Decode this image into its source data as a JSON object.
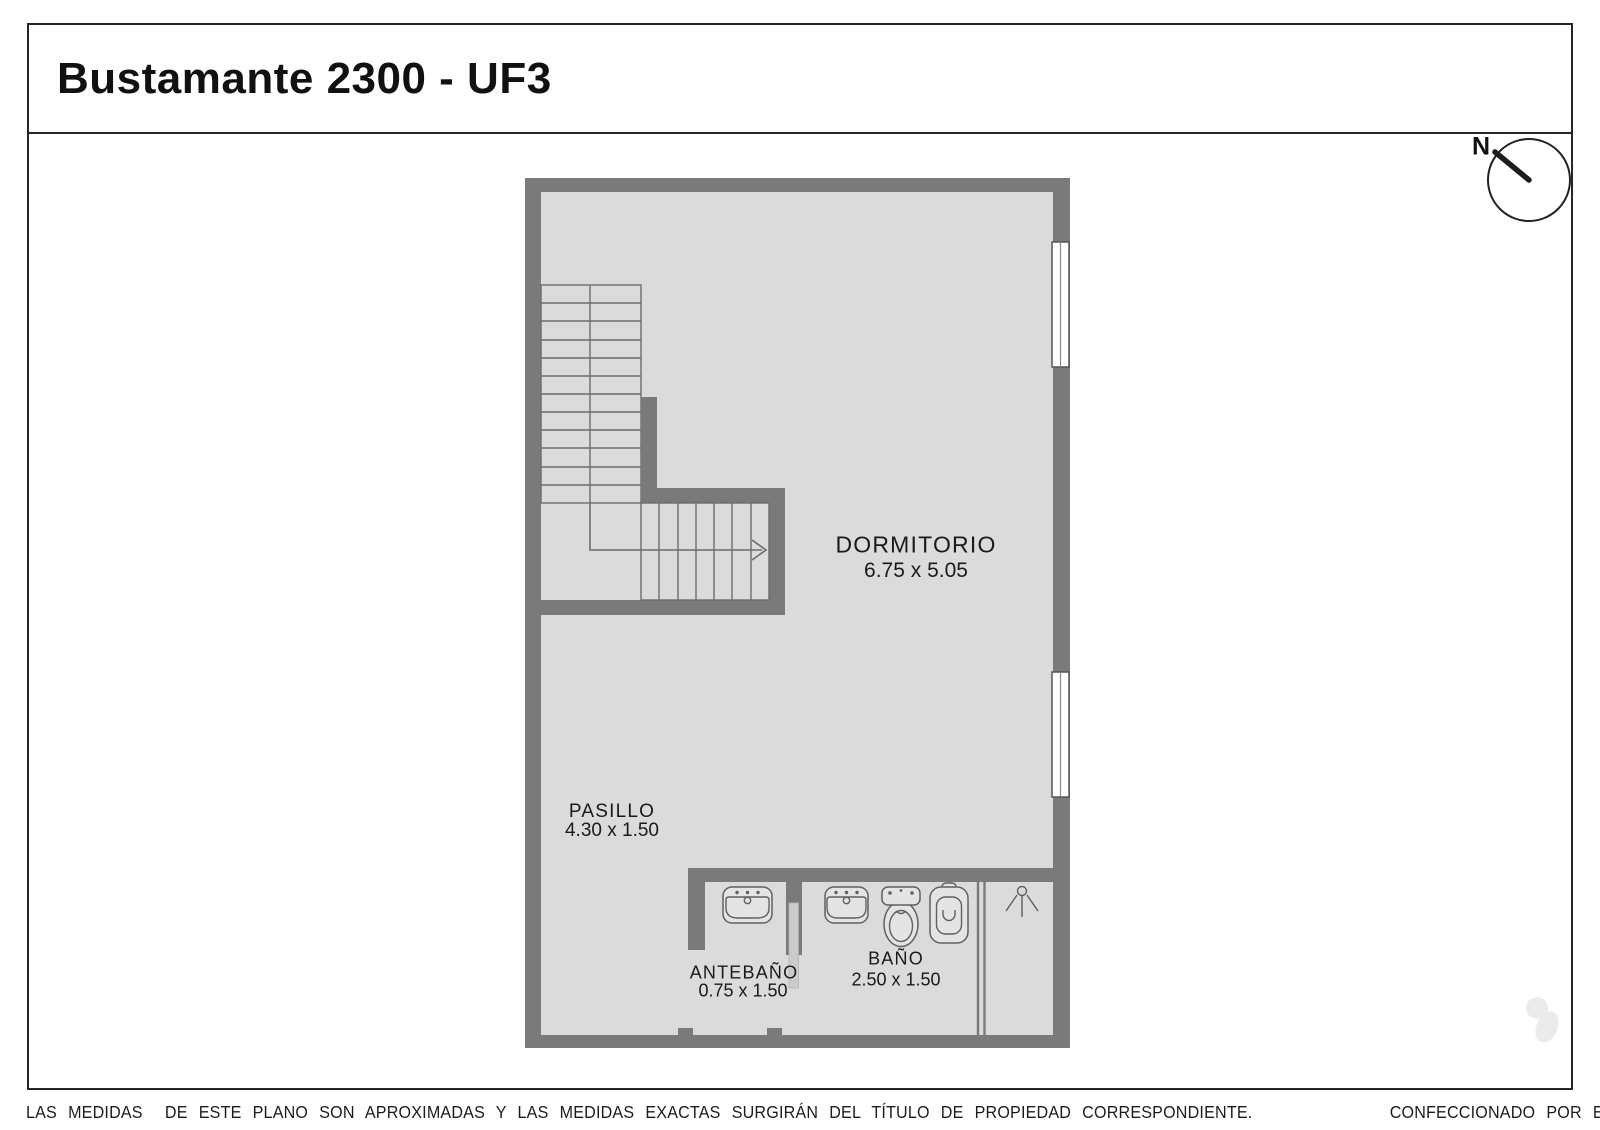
{
  "title": "Bustamante 2300 - UF3",
  "compass": {
    "north": "N"
  },
  "rooms": {
    "dormitorio": {
      "name": "DORMITORIO",
      "dims": "6.75 x 5.05"
    },
    "pasillo": {
      "name": "PASILLO",
      "dims": "4.30 x 1.50"
    },
    "antebano": {
      "name": "ANTEBAÑO",
      "dims": "0.75 x 1.50"
    },
    "bano": {
      "name": "BAÑO",
      "dims": "2.50 x 1.50"
    }
  },
  "footer": {
    "disclaimer": "LAS MEDIDAS  DE ESTE PLANO SON APROXIMADAS Y LAS MEDIDAS EXACTAS SURGIRÁN DEL TÍTULO DE PROPIEDAD CORRESPONDIENTE.",
    "credit": "CONFECCIONADO POR ESTUDIO NARTEX"
  },
  "icons": {
    "compass": "north-arrow",
    "windows": "double-pane-window",
    "shower": "shower-head",
    "fixtures": [
      "sink",
      "sink",
      "bidet",
      "toilet"
    ]
  },
  "colors": {
    "wall": "#7a7a7a",
    "floor": "#dbdbdb",
    "line": "#6d6d6d",
    "fixture": "#606060",
    "frame": "#262626",
    "text": "#1a1a1a",
    "door_leaf": "#cbcbcb",
    "watermark": "#ebebeb"
  }
}
